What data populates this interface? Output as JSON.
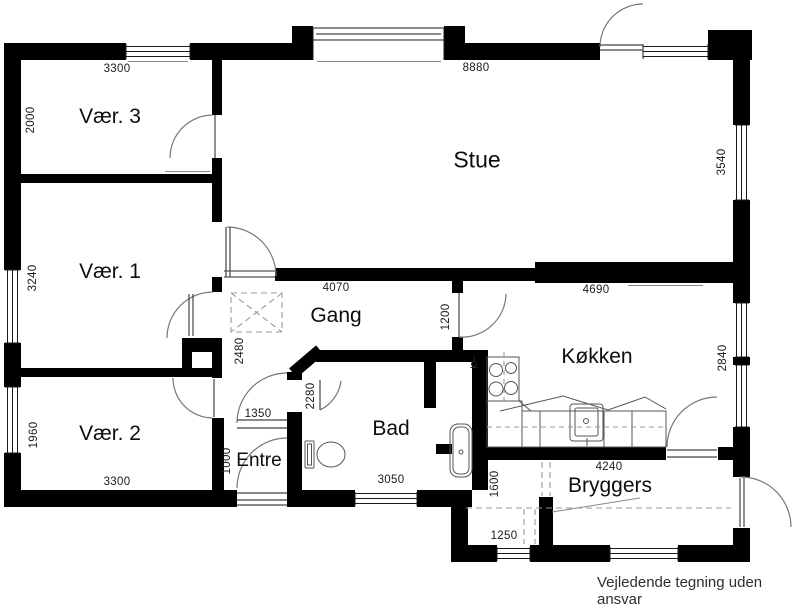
{
  "rooms": {
    "vaer3": "Vær. 3",
    "vaer1": "Vær. 1",
    "vaer2": "Vær. 2",
    "stue": "Stue",
    "gang": "Gang",
    "koekken": "Køkken",
    "entre": "Entre",
    "bad": "Bad",
    "bryggers": "Bryggers"
  },
  "dimensions": {
    "top_3300": "3300",
    "top_8880": "8880",
    "left_2000": "2000",
    "left_3240": "3240",
    "left_1960": "1960",
    "right_3540": "3540",
    "right_2840": "2840",
    "gang_4070": "4070",
    "koekken_4690": "4690",
    "door_1200": "1200",
    "gang_2480": "2480",
    "entre_1350": "1350",
    "bad_2280": "2280",
    "entre_1000": "1000",
    "bad_3050": "3050",
    "bryggers_4240": "4240",
    "bryggers_1600": "1600",
    "bottom_3300": "3300",
    "bryggers_1250": "1250"
  },
  "disclaimer": "Vejledende tegning uden ansvar",
  "colors": {
    "wall": "#000000",
    "line": "#666666",
    "dash": "#999999",
    "text": "#1a1a1a",
    "background": "#ffffff"
  }
}
